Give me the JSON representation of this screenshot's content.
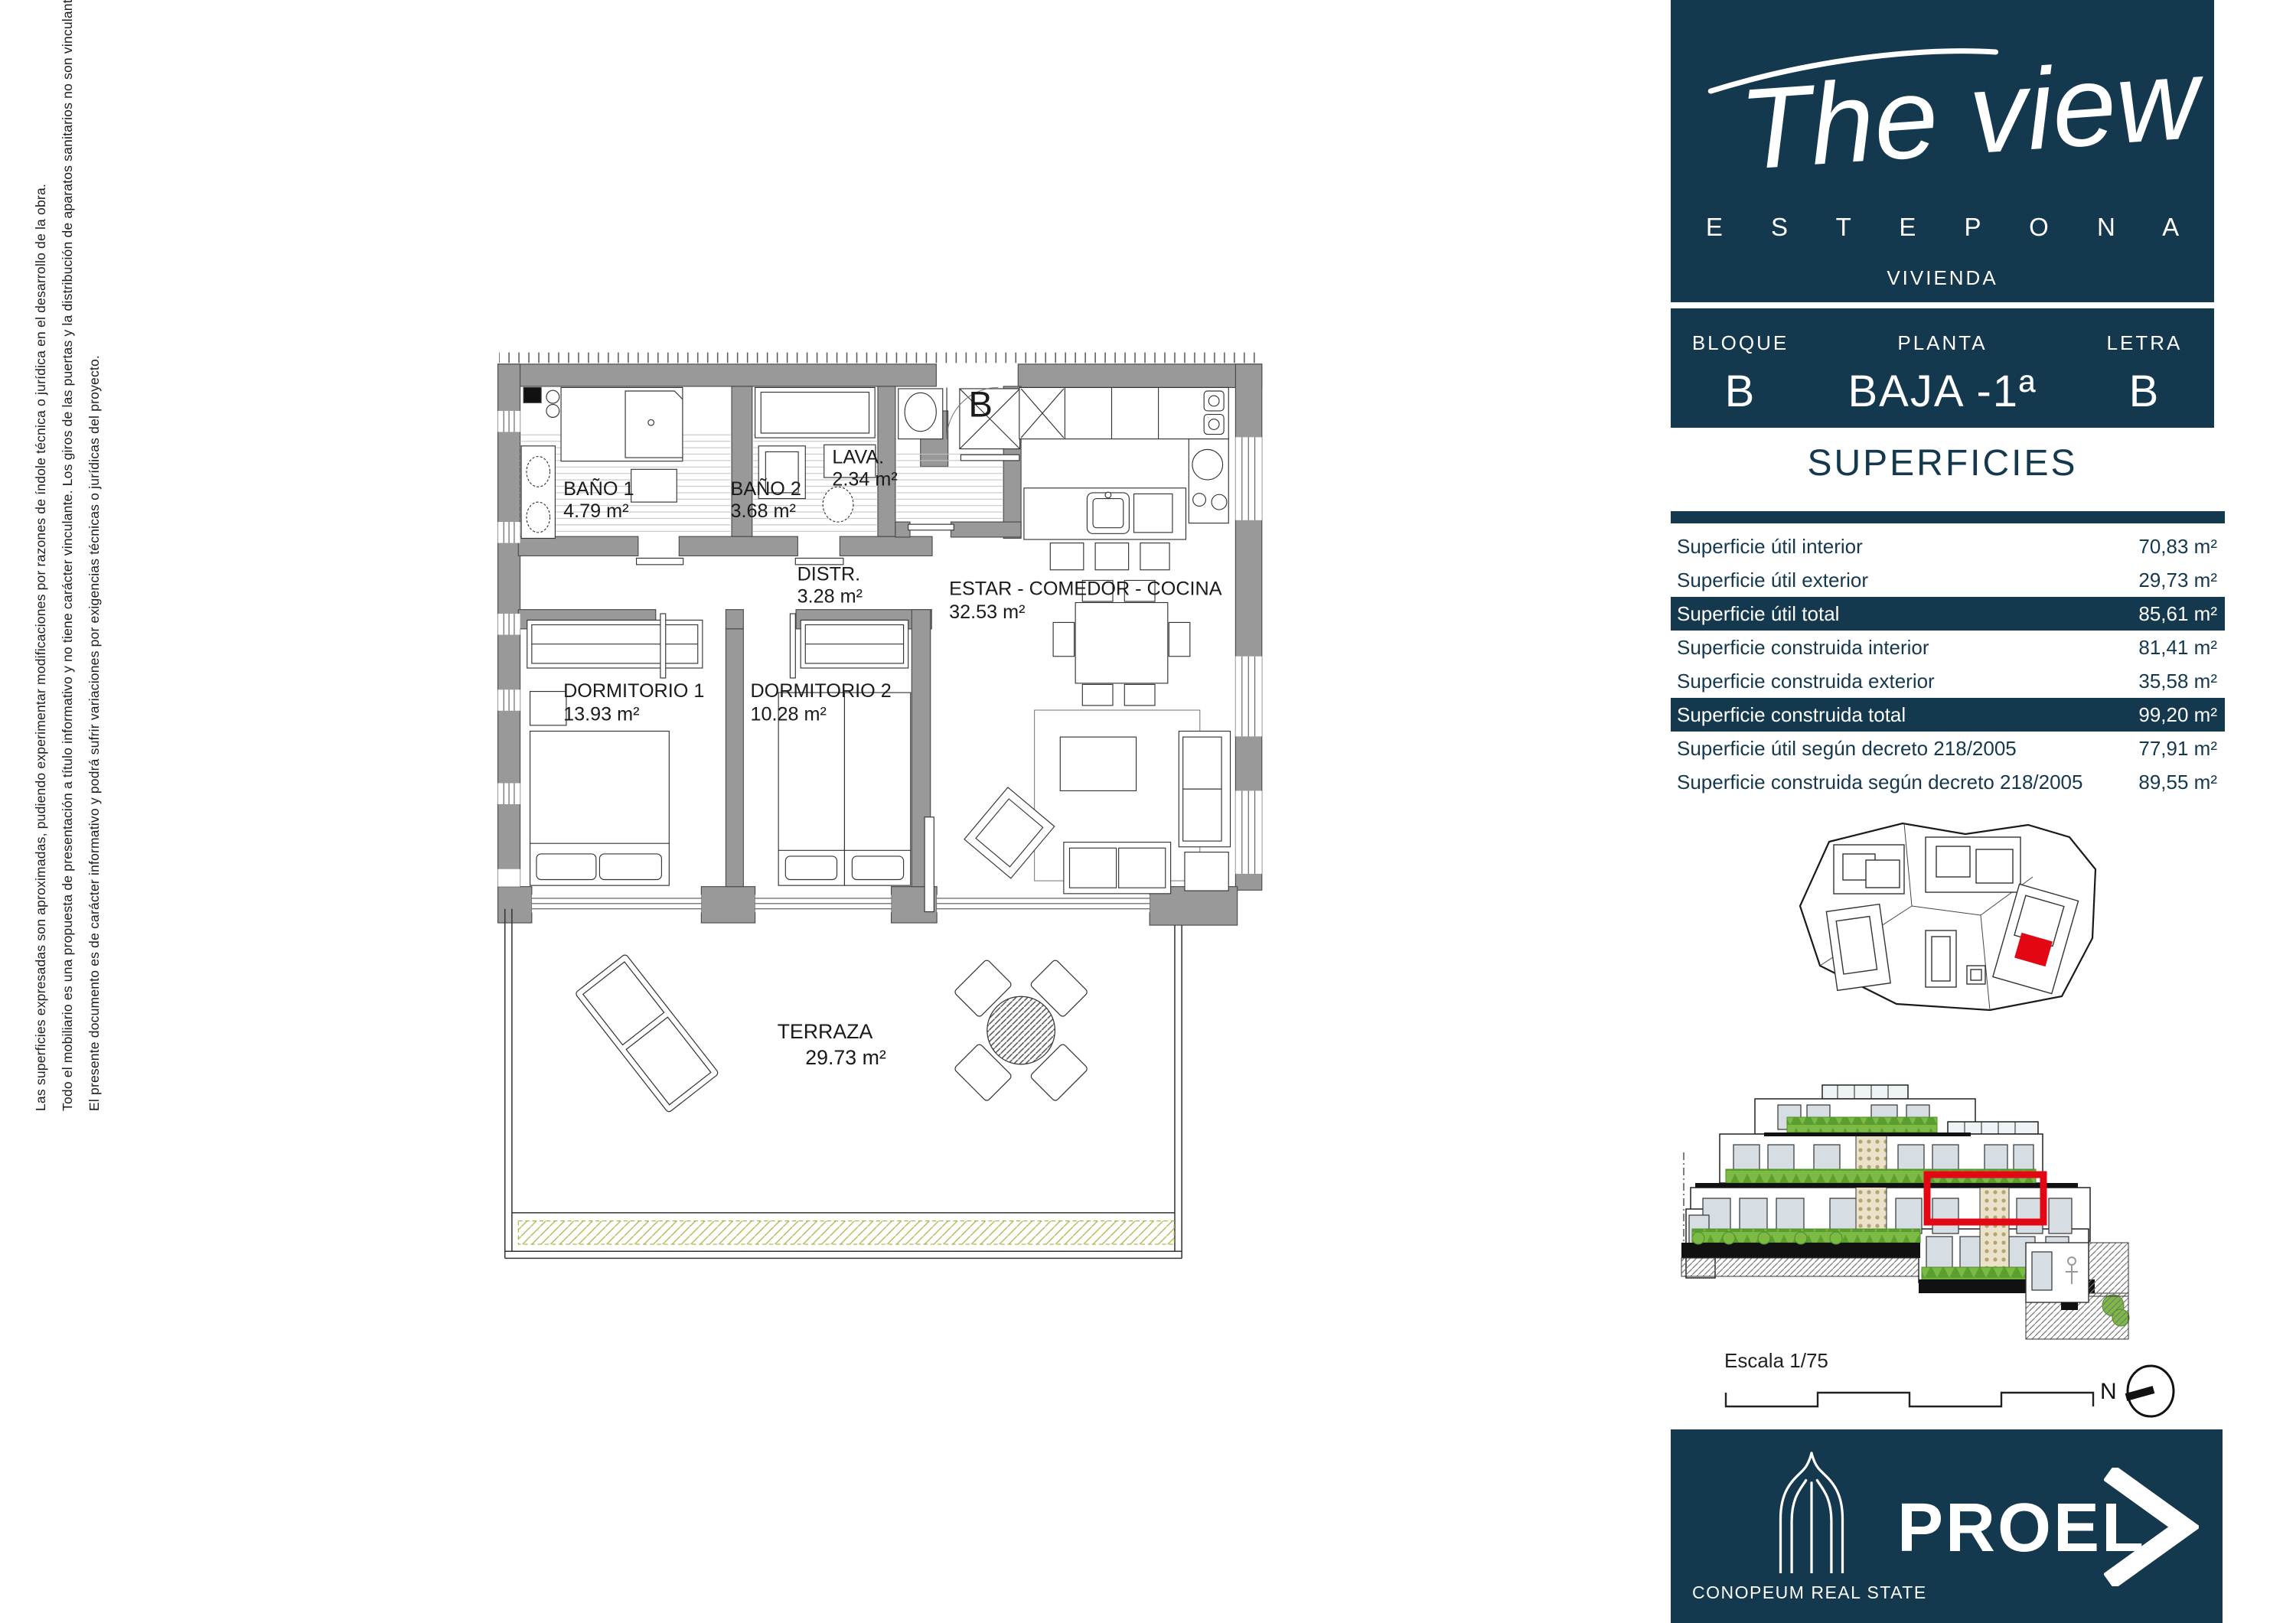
{
  "colors": {
    "navy": "#14384d",
    "red": "#e30613",
    "wall_gray": "#999999",
    "hedge_green": "#7cb945",
    "olive": "#a8b03c"
  },
  "sidebar": {
    "logo": {
      "script": "The view",
      "subtitle": "E S T E P O N A",
      "category": "VIVIENDA"
    },
    "unit": {
      "bloque_label": "BLOQUE",
      "bloque_value": "B",
      "planta_label": "PLANTA",
      "planta_value": "BAJA -1ª",
      "letra_label": "LETRA",
      "letra_value": "B"
    },
    "superficies": {
      "title": "SUPERFICIES",
      "rows": [
        {
          "label": "Superficie útil interior",
          "value": "70,83 m²",
          "highlight": false
        },
        {
          "label": "Superficie útil exterior",
          "value": "29,73 m²",
          "highlight": false
        },
        {
          "label": "Superficie útil total",
          "value": "85,61 m²",
          "highlight": true
        },
        {
          "label": "Superficie construida interior",
          "value": "81,41 m²",
          "highlight": false
        },
        {
          "label": "Superficie construida exterior",
          "value": "35,58 m²",
          "highlight": false
        },
        {
          "label": "Superficie construida total",
          "value": "99,20 m²",
          "highlight": true
        },
        {
          "label": "Superficie útil según decreto 218/2005",
          "value": "77,91 m²",
          "highlight": false
        },
        {
          "label": "Superficie construida según decreto 218/2005",
          "value": "89,55 m²",
          "highlight": false
        }
      ]
    },
    "scale_label": "Escala 1/75",
    "north_label": "N",
    "footer": {
      "brand": "PROEL",
      "company": "CONOPEUM REAL STATE"
    }
  },
  "plan": {
    "unit_letter": "B",
    "rooms": [
      {
        "name": "BAÑO 1",
        "area": "4.79 m²"
      },
      {
        "name": "BAÑO 2",
        "area": "3.68 m²"
      },
      {
        "name": "LAVA.",
        "area": "2.34 m²"
      },
      {
        "name": "DISTR.",
        "area": "3.28 m²"
      },
      {
        "name": "DORMITORIO 1",
        "area": "13.93 m²"
      },
      {
        "name": "DORMITORIO 2",
        "area": "10.28 m²"
      },
      {
        "name": "ESTAR - COMEDOR - COCINA",
        "area": "32.53 m²"
      },
      {
        "name": "TERRAZA",
        "area": "29.73 m²"
      }
    ]
  },
  "disclaimer": {
    "lines": [
      "El presente documento es de carácter informativo y podrá sufrir variaciones por exigencias técnicas o jurídicas del proyecto.",
      "Todo el mobiliario es una propuesta de presentación a título informativo y no tiene carácter vinculante. Los giros de las puertas y la distribución de aparatos sanitarios no son vinculantes.",
      "Las superficies expresadas son aproximadas, pudiendo experimentar modificaciones por razones de índole técnica o jurídica en el desarrollo de la obra."
    ]
  }
}
